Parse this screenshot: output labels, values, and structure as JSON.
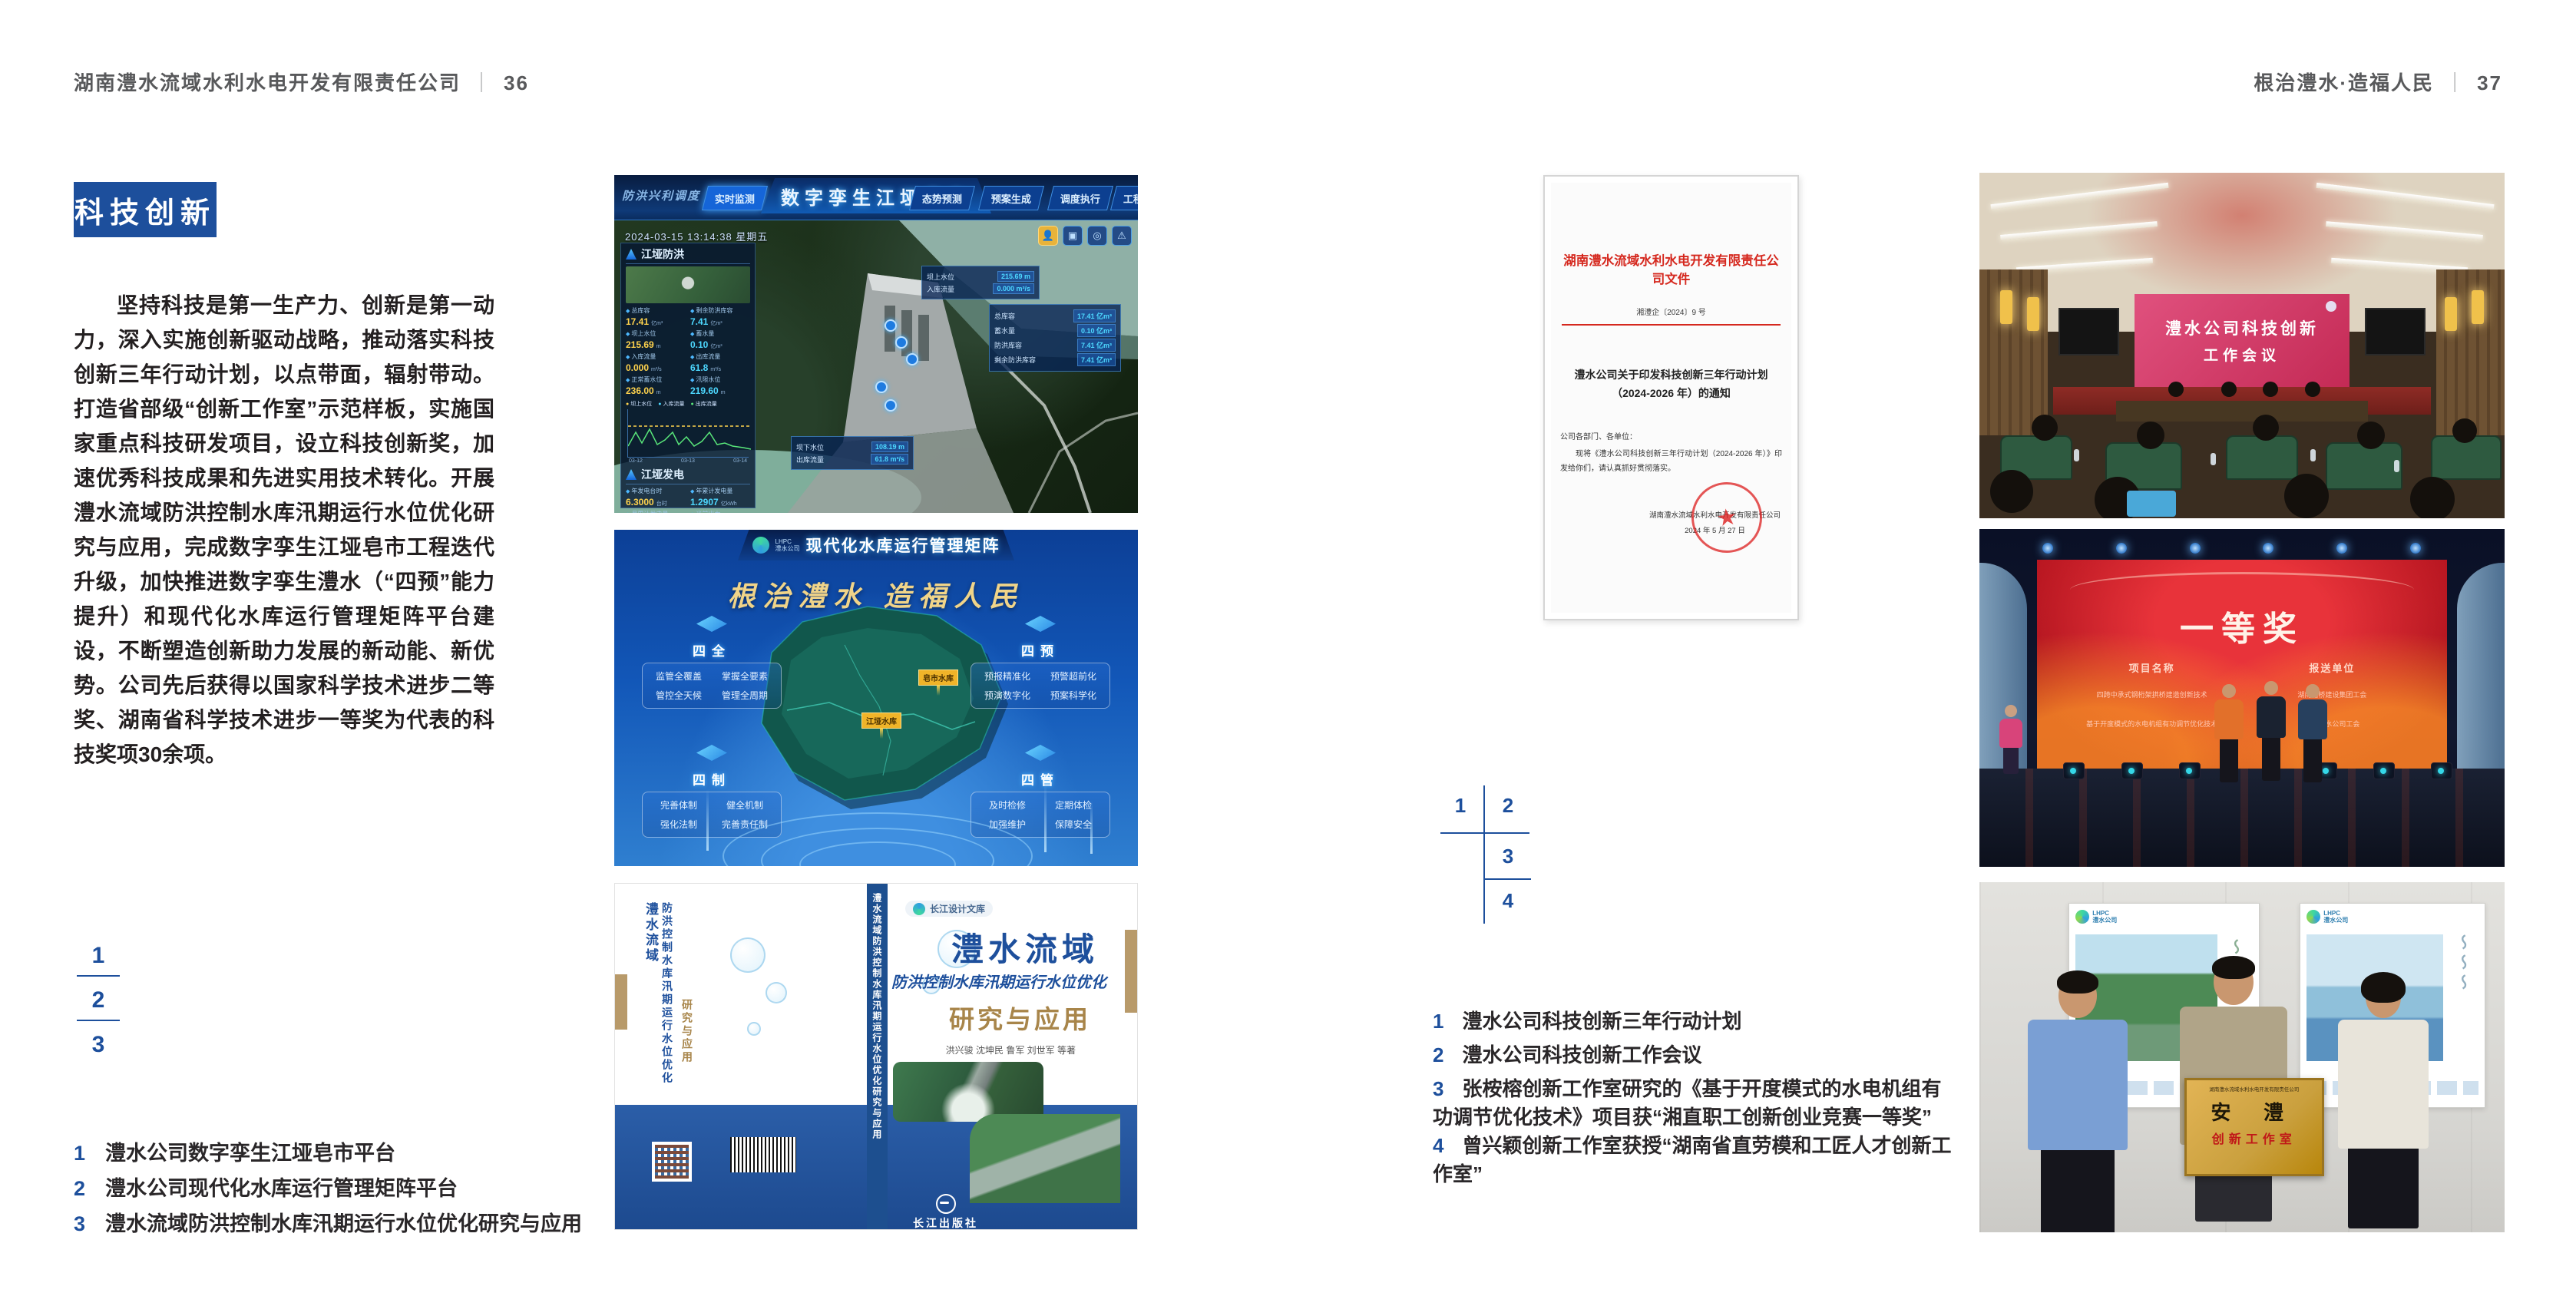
{
  "brand": {
    "lhpc": "LHPC",
    "company_short": "澧水公司"
  },
  "header_left": {
    "title": "湖南澧水流域水利水电开发有限责任公司",
    "divider": "｜",
    "page": "36"
  },
  "header_right": {
    "title": "根治澧水·造福人民",
    "divider": "｜",
    "page": "37"
  },
  "left_page": {
    "badge": "科技创新",
    "paragraph": "坚持科技是第一生产力、创新是第一动力，深入实施创新驱动战略，推动落实科技创新三年行动计划，以点带面，辐射带动。打造省部级“创新工作室”示范样板，实施国家重点科技研发项目，设立科技创新奖，加速优秀科技成果和先进实用技术转化。开展澧水流域防洪控制水库汛期运行水位优化研究与应用，完成数字孪生江垭皂市工程迭代升级，加快推进数字孪生澧水（“四预”能力提升）和现代化水库运行管理矩阵平台建设，不断塑造创新助力发展的新动能、新优势。公司先后获得以国家科学技术进步二等奖、湖南省科学技术进步一等奖为代表的科技奖项30余项。",
    "figure_index": [
      "1",
      "2",
      "3"
    ],
    "captions": [
      {
        "no": "1",
        "text": "澧水公司数字孪生江垭皂市平台"
      },
      {
        "no": "2",
        "text": "澧水公司现代化水库运行管理矩阵平台"
      },
      {
        "no": "3",
        "text": "澧水流域防洪控制水库汛期运行水位优化研究与应用"
      }
    ]
  },
  "right_page": {
    "figure_index": [
      "1",
      "2",
      "3",
      "4"
    ],
    "captions": [
      {
        "no": "1",
        "text": "澧水公司科技创新三年行动计划"
      },
      {
        "no": "2",
        "text": "澧水公司科技创新工作会议"
      },
      {
        "no": "3",
        "text": "张桉榕创新工作室研究的《基于开度模式的水电机组有功调节优化技术》项目获“湘直职工创新创业竞赛一等奖”"
      },
      {
        "no": "4",
        "text": "曾兴颖创新工作室获授“湖南省直劳模和工匠人才创新工作室”"
      }
    ]
  },
  "document": {
    "org_title": "湖南澧水流域水利水电开发有限责任公司文件",
    "doc_no": "湘澧企〔2024〕9 号",
    "title_line1": "澧水公司关于印发科技创新三年行动计划",
    "title_line2": "（2024-2026 年）的通知",
    "salutation": "公司各部门、各单位：",
    "body": "现将《澧水公司科技创新三年行动计划（2024-2026 年）》印发给你们，请认真抓好贯彻落实。",
    "signer": "湖南澧水流域水利水电开发有限责任公司",
    "date": "2024 年 5 月 27 日",
    "seal_star": "★"
  },
  "dashboard": {
    "nav_label": "防洪兴利调度",
    "tabs_left": [
      "实时监测",
      "洪水预报",
      "防洪预警"
    ],
    "title": "数字孪生江垭皂市",
    "tabs_right": [
      "态势预测",
      "预案生成",
      "调度执行",
      "工程巡视"
    ],
    "datetime": "2024-03-15 13:14:38 星期五",
    "panel_flood": {
      "title": "江垭防洪",
      "stats": [
        {
          "label": "总库容",
          "value": "17.41",
          "unit": "亿m³"
        },
        {
          "label": "剩余防洪库容",
          "value": "7.41",
          "unit": "亿m³"
        },
        {
          "label": "坝上水位",
          "value": "215.69",
          "unit": "m"
        },
        {
          "label": "蓄水量",
          "value": "0.10",
          "unit": "亿m³"
        },
        {
          "label": "入库流量",
          "value": "0.000",
          "unit": "m³/s"
        },
        {
          "label": "出库流量",
          "value": "61.8",
          "unit": "m³/s"
        },
        {
          "label": "正常蓄水位",
          "value": "236.00",
          "unit": "m"
        },
        {
          "label": "汛限水位",
          "value": "219.60",
          "unit": "m"
        }
      ],
      "legend": [
        "坝上水位",
        "入库流量",
        "出库流量"
      ],
      "x_ticks": [
        "03-12",
        "03-13",
        "03-14"
      ]
    },
    "panel_power": {
      "title": "江垭发电",
      "stats": [
        {
          "label": "年发电台时",
          "value": "6.3000",
          "unit": "台时"
        },
        {
          "label": "年累计发电量",
          "value": "1.2907",
          "unit": "亿kWh"
        },
        {
          "label": "月累计发电量",
          "value": "3359.21",
          "unit": "万kWh"
        },
        {
          "label": "当前出力",
          "value": "0.00",
          "unit": "MW"
        },
        {
          "label": "发电流量",
          "value": "0.00",
          "unit": "m³/s"
        },
        {
          "label": "弃水流量",
          "value": "0.00",
          "unit": "m³/s"
        }
      ],
      "gauges": [
        "0.00",
        "102.98",
        "0.00"
      ]
    },
    "overlays": {
      "box_top": [
        {
          "label": "坝上水位",
          "value": "215.69 m"
        },
        {
          "label": "入库流量",
          "value": "0.000 m³/s"
        }
      ],
      "box_right": [
        {
          "label": "总库容",
          "value": "17.41 亿m³"
        },
        {
          "label": "蓄水量",
          "value": "0.10 亿m³"
        },
        {
          "label": "防洪库容",
          "value": "7.41 亿m³"
        },
        {
          "label": "剩余防洪库容",
          "value": "7.41 亿m³"
        }
      ],
      "box_bottom": [
        {
          "label": "坝下水位",
          "value": "108.19 m"
        },
        {
          "label": "出库流量",
          "value": "61.8 m³/s"
        }
      ]
    }
  },
  "matrix": {
    "title": "现代化水库运行管理矩阵",
    "slogan": "根治澧水 造福人民",
    "panels": [
      {
        "title": "四全",
        "items": [
          "监管全覆盖",
          "掌握全要素",
          "管控全天候",
          "管理全周期"
        ]
      },
      {
        "title": "四预",
        "items": [
          "预报精准化",
          "预警超前化",
          "预演数字化",
          "预案科学化"
        ]
      },
      {
        "title": "四制",
        "items": [
          "完善体制",
          "健全机制",
          "强化法制",
          "完善责任制"
        ]
      },
      {
        "title": "四管",
        "items": [
          "及时检修",
          "定期体检",
          "加强维护",
          "保障安全"
        ]
      }
    ],
    "map_labels": [
      "皂市水库",
      "江垭水库"
    ]
  },
  "book": {
    "series": "长江设计文库",
    "title": "澧水流域",
    "subtitle": "防洪控制水库汛期运行水位优化",
    "subtitle2": "研究与应用",
    "authors": "洪兴骏  沈坤民  鲁军  刘世军  等著",
    "publisher": "长江出版社",
    "publisher_en": "CHANGJIANG PRESS",
    "spine": "澧水流域防洪控制水库汛期运行水位优化研究与应用",
    "back_title1": "澧水流域",
    "back_title2": "防洪控制水库汛期运行水位优化",
    "back_title3": "研究与应用"
  },
  "photos": {
    "meeting": {
      "screen_line1": "澧水公司科技创新",
      "screen_line2": "工作会议"
    },
    "award": {
      "title": "一等奖",
      "col_project": "项目名称",
      "col_org": "报送单位",
      "rows": [
        {
          "project": "四跨中承式钢桁架拱桥建造创新技术",
          "org": "湖南路桥建设集团工会"
        },
        {
          "project": "基于开度模式的水电机组有功调节优化技术",
          "org": "湖南澧水公司工会"
        }
      ]
    },
    "plaque": {
      "top": "湖南澧水流域水利水电开发有限责任公司",
      "main": "安 澧",
      "sub": "创新工作室"
    }
  }
}
